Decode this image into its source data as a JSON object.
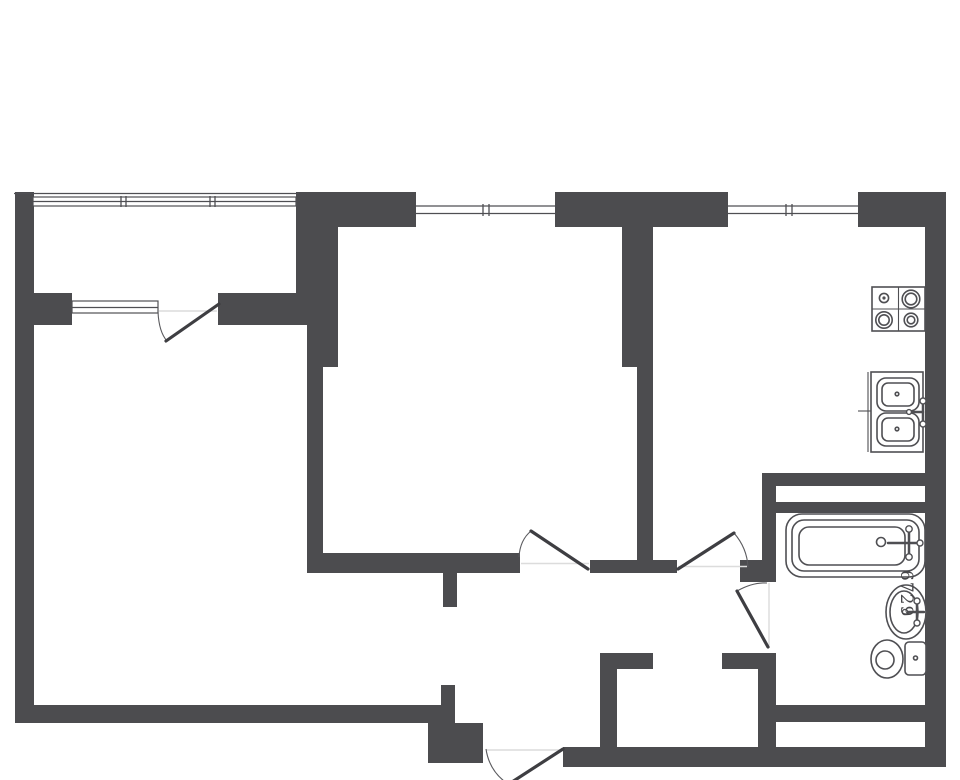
{
  "canvas": {
    "width": 960,
    "height": 780,
    "background": "#ffffff"
  },
  "palette": {
    "wall": "#4c4c4f",
    "fixture_line": "#4f4f53",
    "door_leaf": "#3e3e42",
    "swing_arc": "#5a5a5e",
    "threshold": "#dcdcdc",
    "label_text": "#47474a"
  },
  "labels": {
    "bath_dimension": "6729"
  },
  "rooms": [
    {
      "name": "balcony"
    },
    {
      "name": "living-room"
    },
    {
      "name": "bedroom"
    },
    {
      "name": "kitchen"
    },
    {
      "name": "hallway"
    },
    {
      "name": "bathroom"
    },
    {
      "name": "closet"
    }
  ],
  "windows": [
    {
      "name": "balcony-glazing-band"
    },
    {
      "name": "balcony-inner-window"
    },
    {
      "name": "bedroom-window"
    },
    {
      "name": "kitchen-window"
    }
  ],
  "doors": [
    {
      "name": "balcony-door"
    },
    {
      "name": "bedroom-door"
    },
    {
      "name": "kitchen-door"
    },
    {
      "name": "bathroom-door"
    },
    {
      "name": "entrance-door"
    }
  ],
  "fixtures": [
    {
      "name": "bathtub-icon"
    },
    {
      "name": "washbasin-icon"
    },
    {
      "name": "toilet-icon"
    },
    {
      "name": "stove-icon"
    },
    {
      "name": "kitchen-sink-icon"
    }
  ]
}
